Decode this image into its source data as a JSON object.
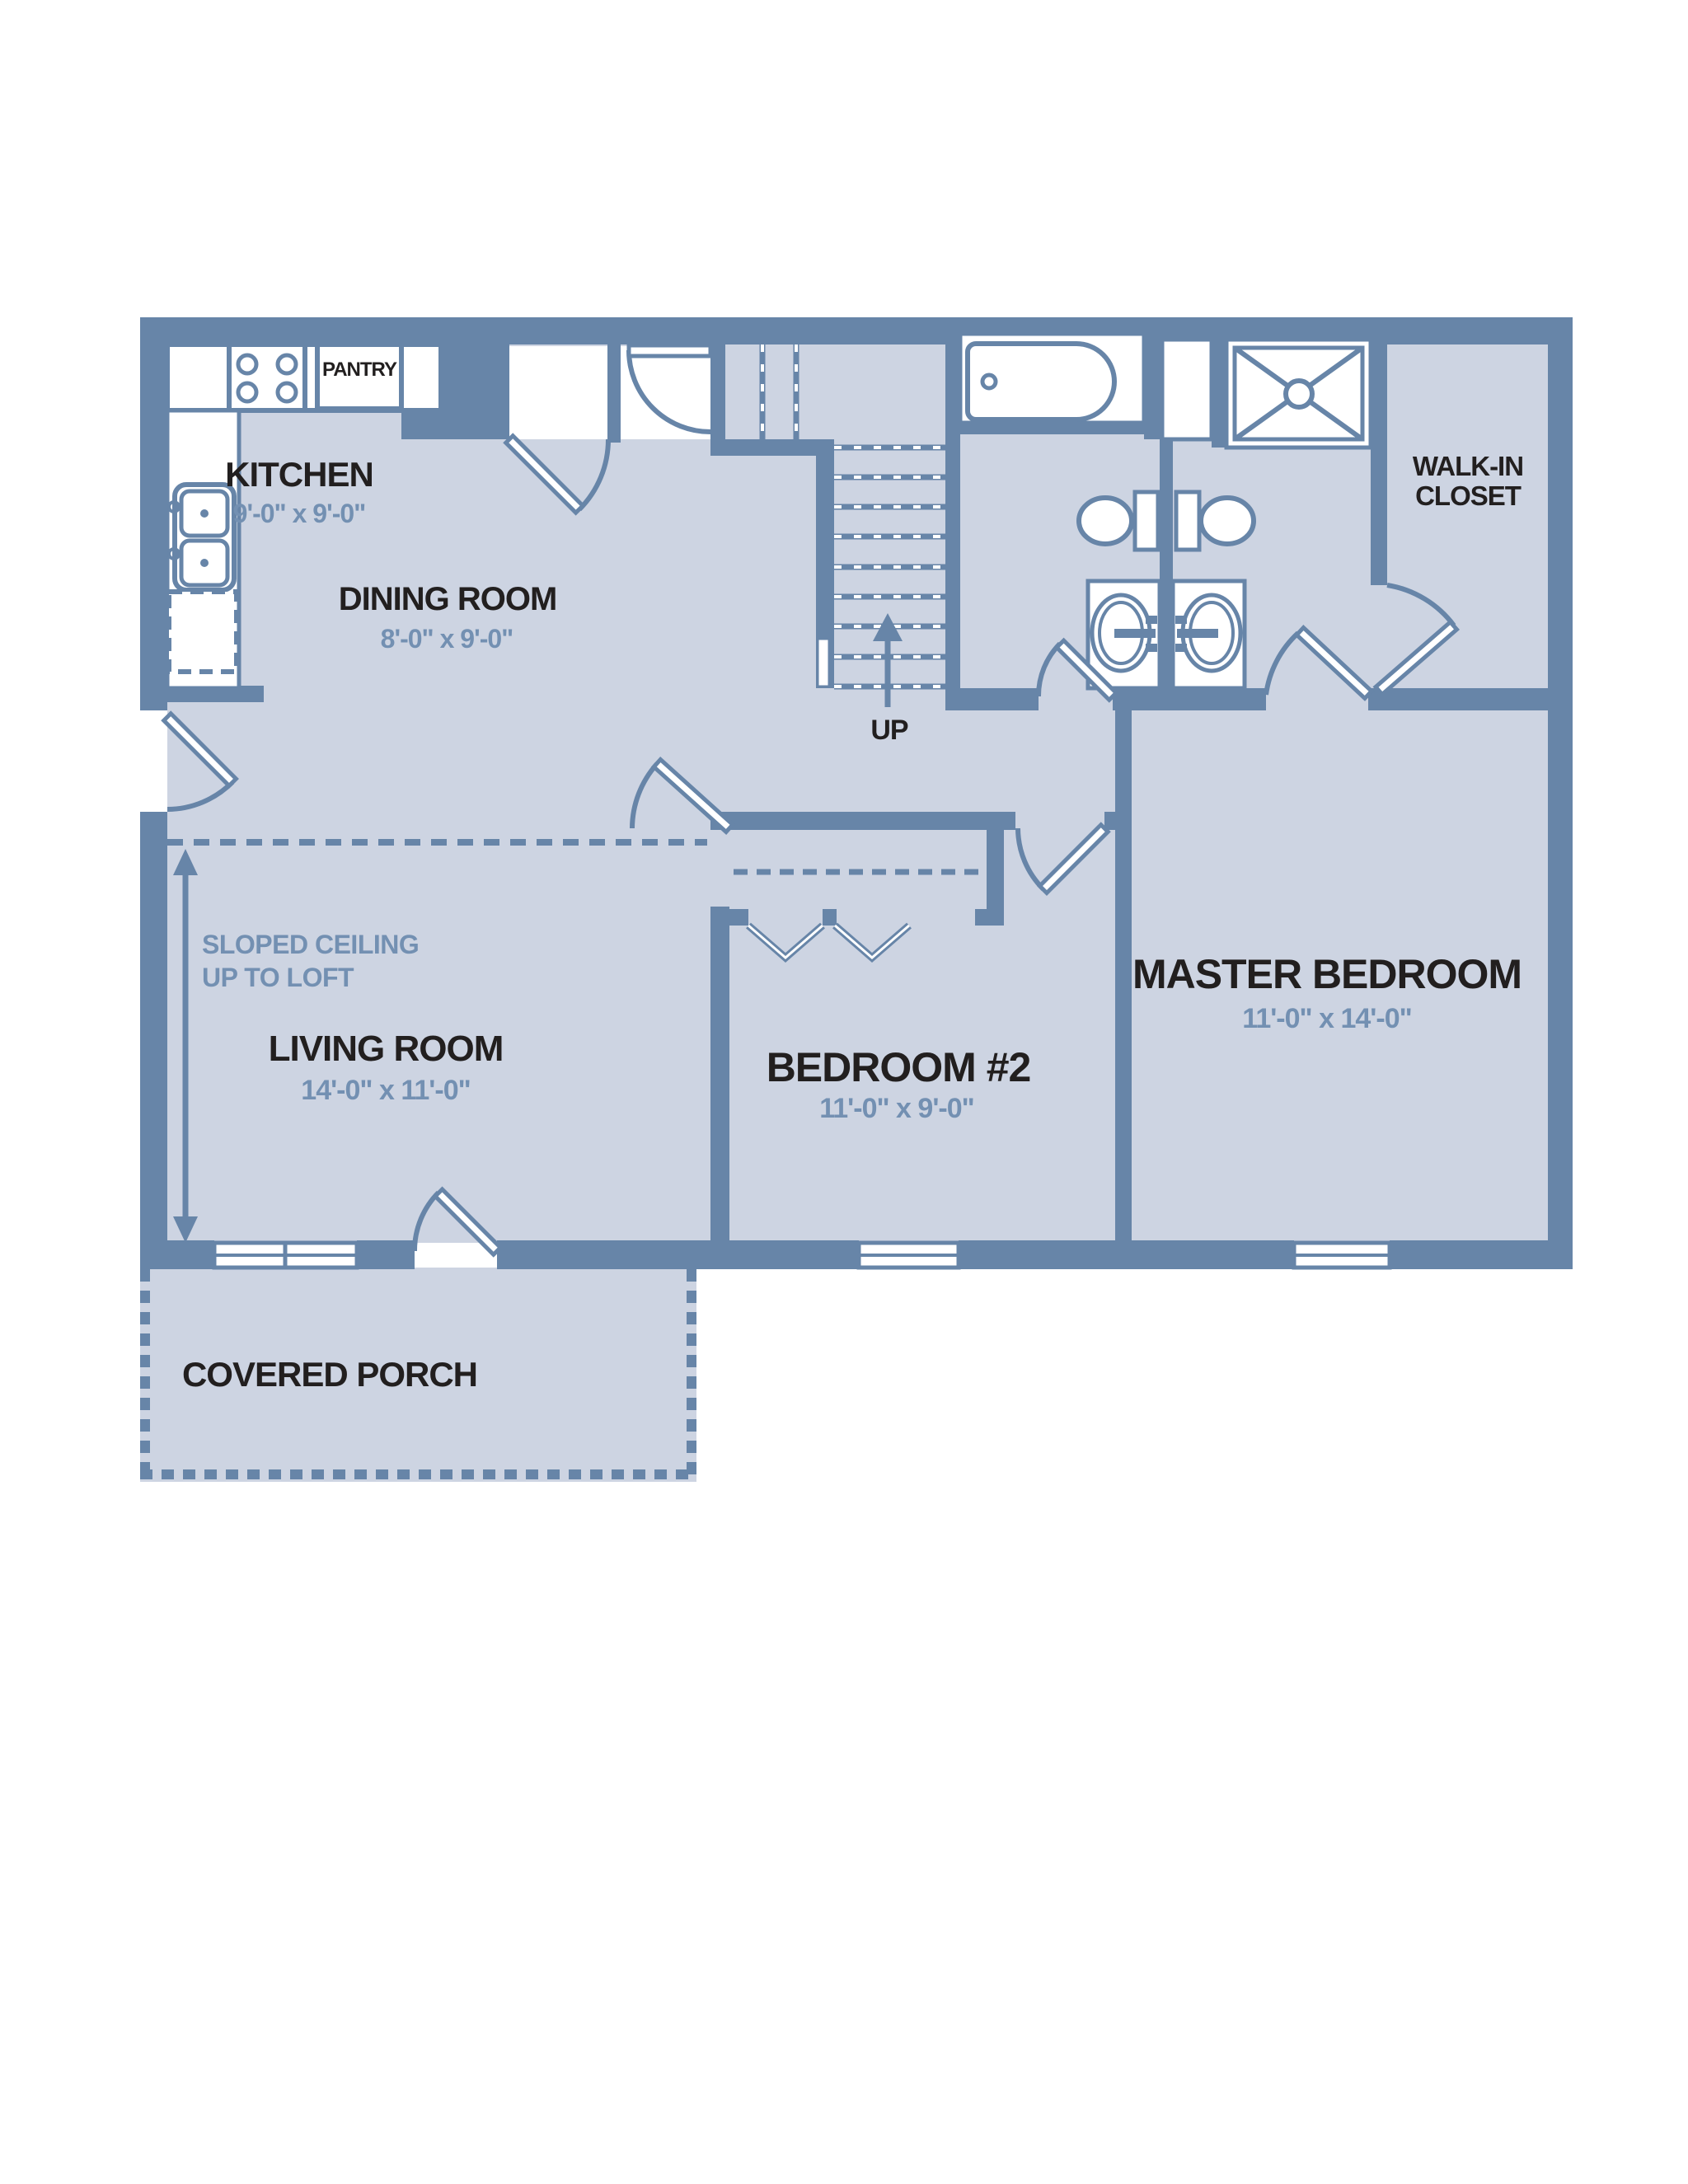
{
  "colors": {
    "floor": "#cdd4e2",
    "wall": "#6785a8",
    "dimension_text": "#7390b2",
    "label_text": "#221f1f",
    "fixture_fill": "#ffffff"
  },
  "rooms": {
    "kitchen": {
      "label": "KITCHEN",
      "dims": "9'-0\" x 9'-0\""
    },
    "dining_room": {
      "label": "DINING ROOM",
      "dims": "8'-0\" x 9'-0\""
    },
    "living_room": {
      "label": "LIVING ROOM",
      "dims": "14'-0\" x 11'-0\""
    },
    "master_bedroom": {
      "label": "MASTER BEDROOM",
      "dims": "11'-0\" x 14'-0\""
    },
    "bedroom_2": {
      "label": "BEDROOM #2",
      "dims": "11'-0\" x 9'-0\""
    },
    "walk_in_closet": {
      "label_line1": "WALK-IN",
      "label_line2": "CLOSET"
    },
    "pantry": {
      "label": "PANTRY"
    },
    "covered_porch": {
      "label": "COVERED PORCH"
    }
  },
  "annotations": {
    "stairs_direction": "UP",
    "sloped_ceiling_line1": "SLOPED CEILING",
    "sloped_ceiling_line2": "UP TO LOFT"
  },
  "fixtures": [
    "kitchen-sink",
    "range-stove",
    "refrigerator",
    "bathtub",
    "shower",
    "toilet",
    "vanity-sink",
    "stairs",
    "bifold-closet-doors"
  ]
}
